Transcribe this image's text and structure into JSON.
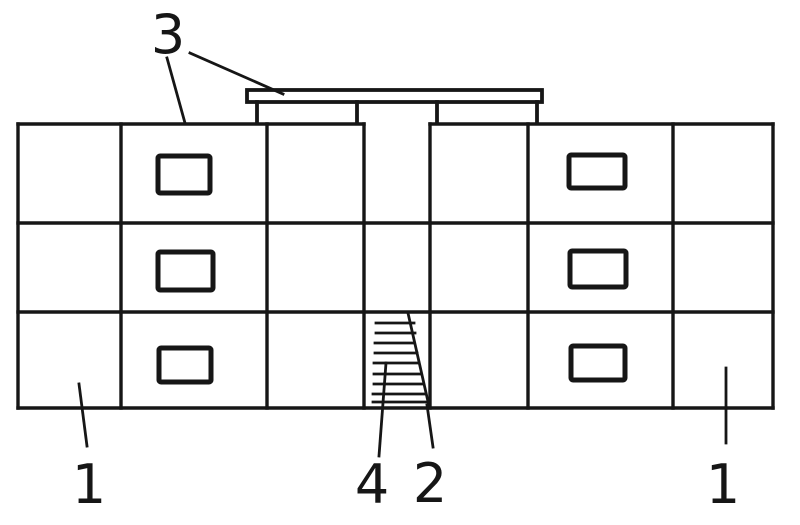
{
  "drawing": {
    "background_color": "#ffffff",
    "ink_color": "#161616",
    "reference_numerals": {
      "left_building_section": "1",
      "right_building_section": "1",
      "stair_stringer": "2",
      "roof_canopy": "3",
      "stair_treads": "4"
    }
  }
}
